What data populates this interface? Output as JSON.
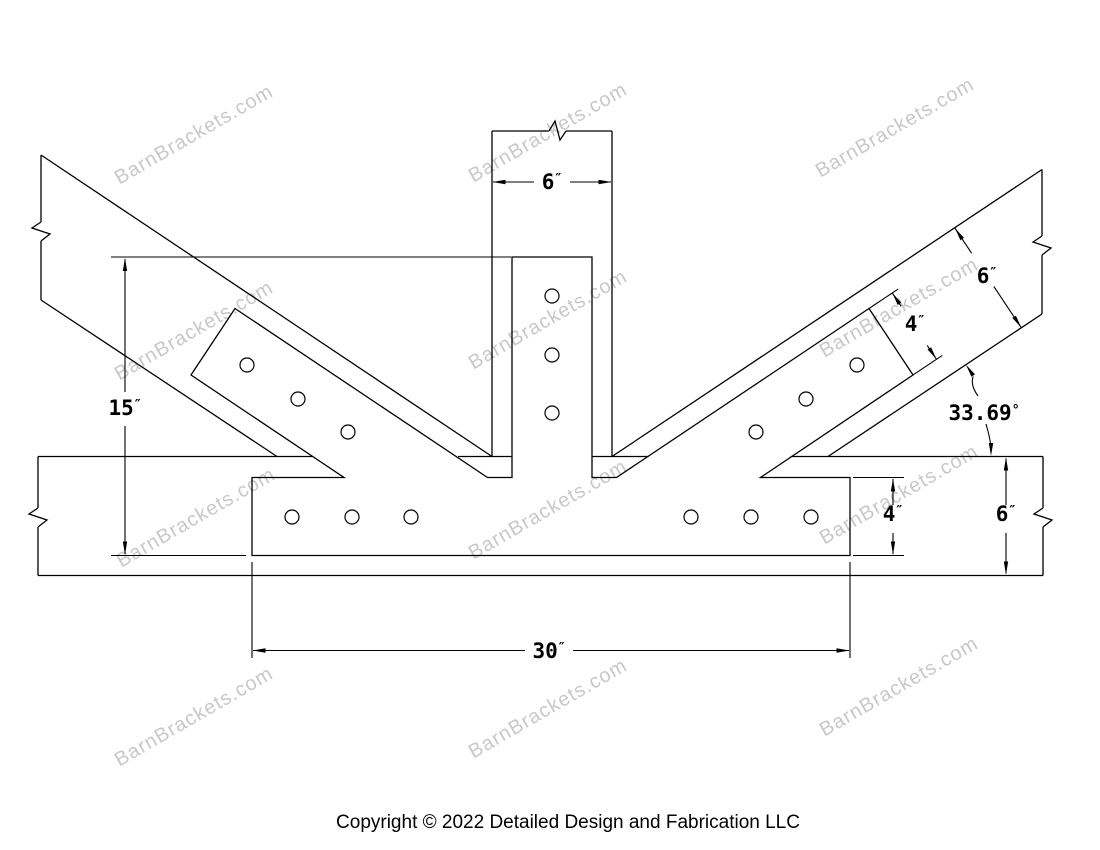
{
  "drawing": {
    "watermark": {
      "text": "BarnBrackets.com",
      "color": "#c8c8c8"
    },
    "footer": {
      "copyright": "Copyright © 2022 Detailed Design and Fabrication LLC"
    },
    "line_color": "#000000",
    "dims": {
      "post_width": {
        "value": "6",
        "unit": "″"
      },
      "bracket_height": {
        "value": "15",
        "unit": "″"
      },
      "strut_strap_width": {
        "value": "4",
        "unit": "″"
      },
      "strut_depth": {
        "value": "6",
        "unit": "″"
      },
      "strut_angle": {
        "value": "33.69",
        "unit": "°"
      },
      "base_strap_height": {
        "value": "4",
        "unit": "″"
      },
      "beam_depth": {
        "value": "6",
        "unit": "″"
      },
      "base_strap_length": {
        "value": "30",
        "unit": "″"
      }
    }
  }
}
